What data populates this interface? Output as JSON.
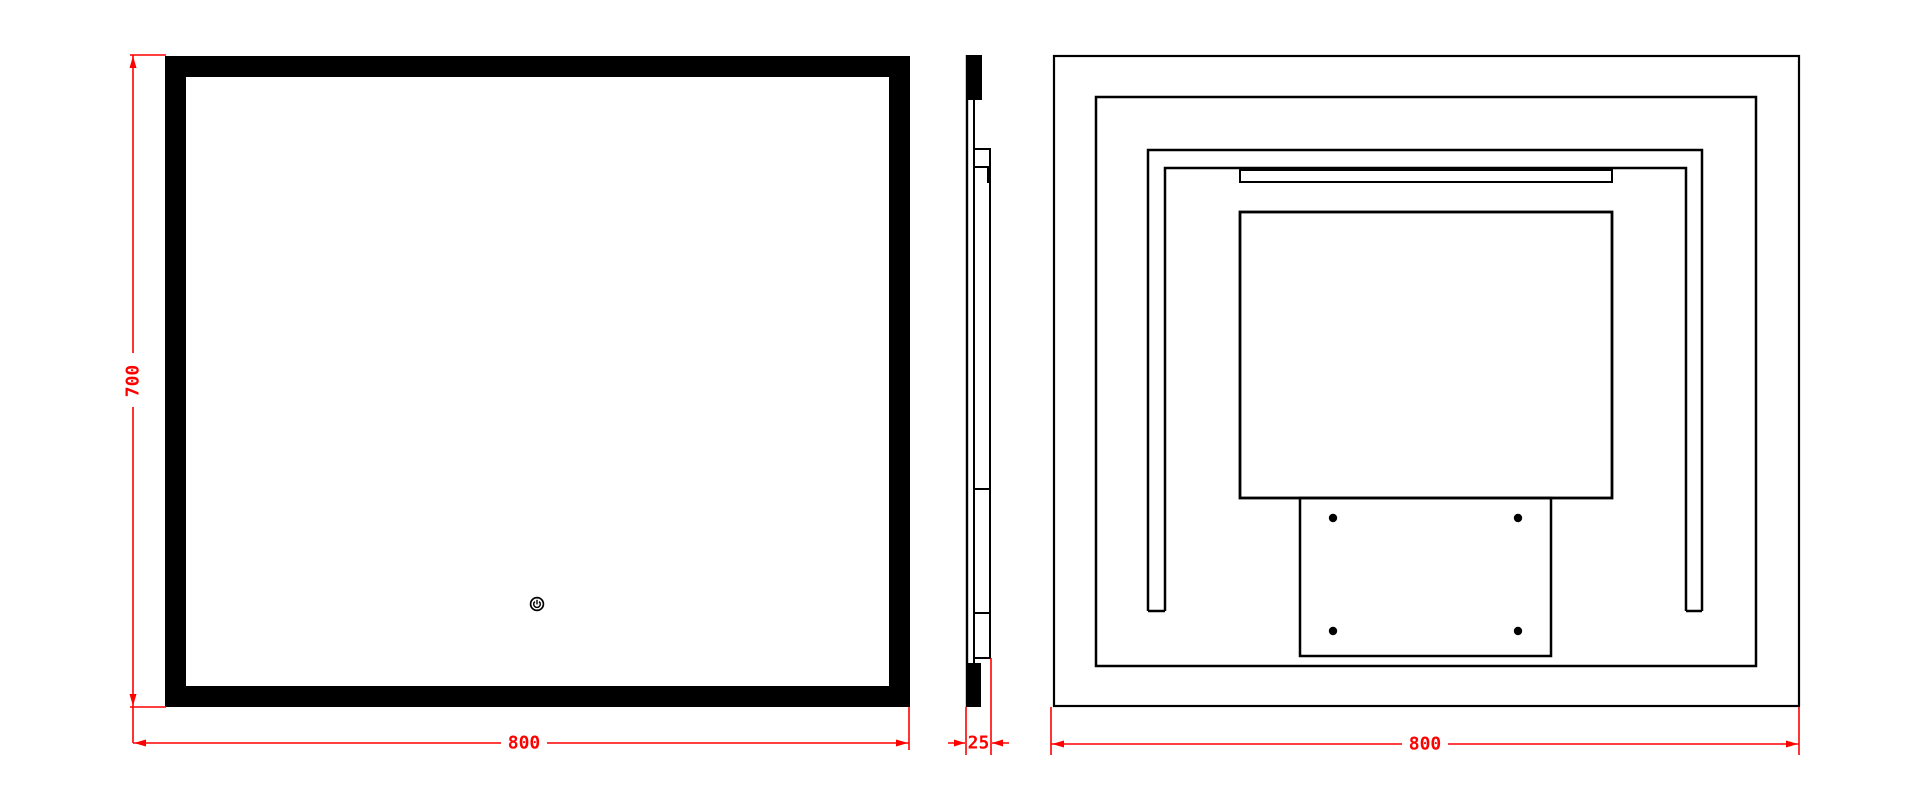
{
  "drawing": {
    "type": "technical-drawing",
    "subject": "led-mirror",
    "colors": {
      "line": "#000000",
      "dimension": "#ff0000",
      "background": "#ffffff"
    },
    "dimensions": {
      "front_height": {
        "label": "700",
        "orientation": "vertical"
      },
      "front_width": {
        "label": "800",
        "orientation": "horizontal"
      },
      "side_depth": {
        "label": "25",
        "orientation": "horizontal"
      },
      "back_width": {
        "label": "800",
        "orientation": "horizontal"
      }
    },
    "icons": {
      "power_sensor": "power-touch-sensor"
    },
    "back_view": {
      "screw_hole_count": 4
    }
  }
}
